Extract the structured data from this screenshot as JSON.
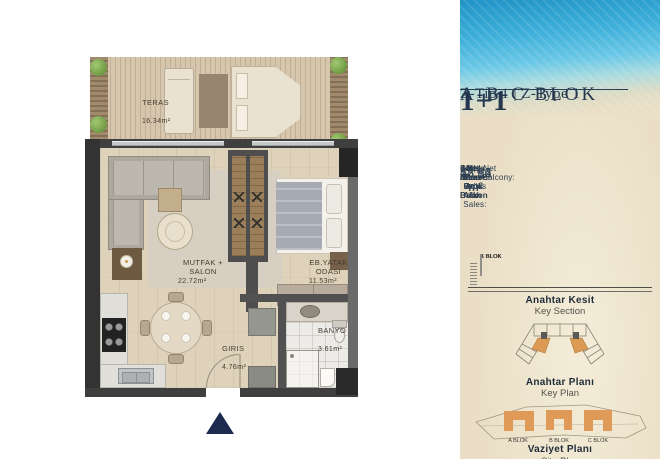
{
  "floor_plan": {
    "teras": {
      "name": "TERAS",
      "area": "16.34m²"
    },
    "salon": {
      "name": "MUTFAK + SALON",
      "area": "22.72m²"
    },
    "bedroom": {
      "name": "EB.YATAK ODASI",
      "area": "11.53m²"
    },
    "entry": {
      "name": "GIRIS",
      "area": "4.76m²"
    },
    "bath": {
      "name": "BANYO",
      "area": "3.61m²"
    }
  },
  "panel": {
    "block_title": "A-B-C BLOK",
    "unit_type": "1+1",
    "variant": "Z-Tip 1 | Z-Type 1",
    "areas": [
      {
        "tr": "Net Alan",
        "en": " | Net Area:",
        "value": "42.62 m²"
      },
      {
        "tr": "Net Alan+ Açık Balkon",
        "en": " | Net Area+Balcony:",
        "value": "58.96 m²"
      },
      {
        "tr": "Satışa Esas Brüt Alan",
        "en": " | General Groos of Sales:",
        "value": "78.14 m²"
      }
    ],
    "key_section": {
      "blocks": [
        "A BLOK",
        "B BLOK",
        "C BLOK"
      ],
      "title": "Anahtar Kesit",
      "subtitle": "Key Section"
    },
    "key_plan": {
      "title": "Anahtar Planı",
      "subtitle": "Key Plan"
    },
    "site_plan": {
      "blocks": [
        "A BLOK",
        "B BLOK",
        "C BLOK"
      ],
      "title": "Vaziyet Planı",
      "subtitle": "Site Plan"
    }
  },
  "colors": {
    "accent_orange": "#dd9a54",
    "navy": "#25374e",
    "triangle_navy": "#1c2b4e"
  }
}
